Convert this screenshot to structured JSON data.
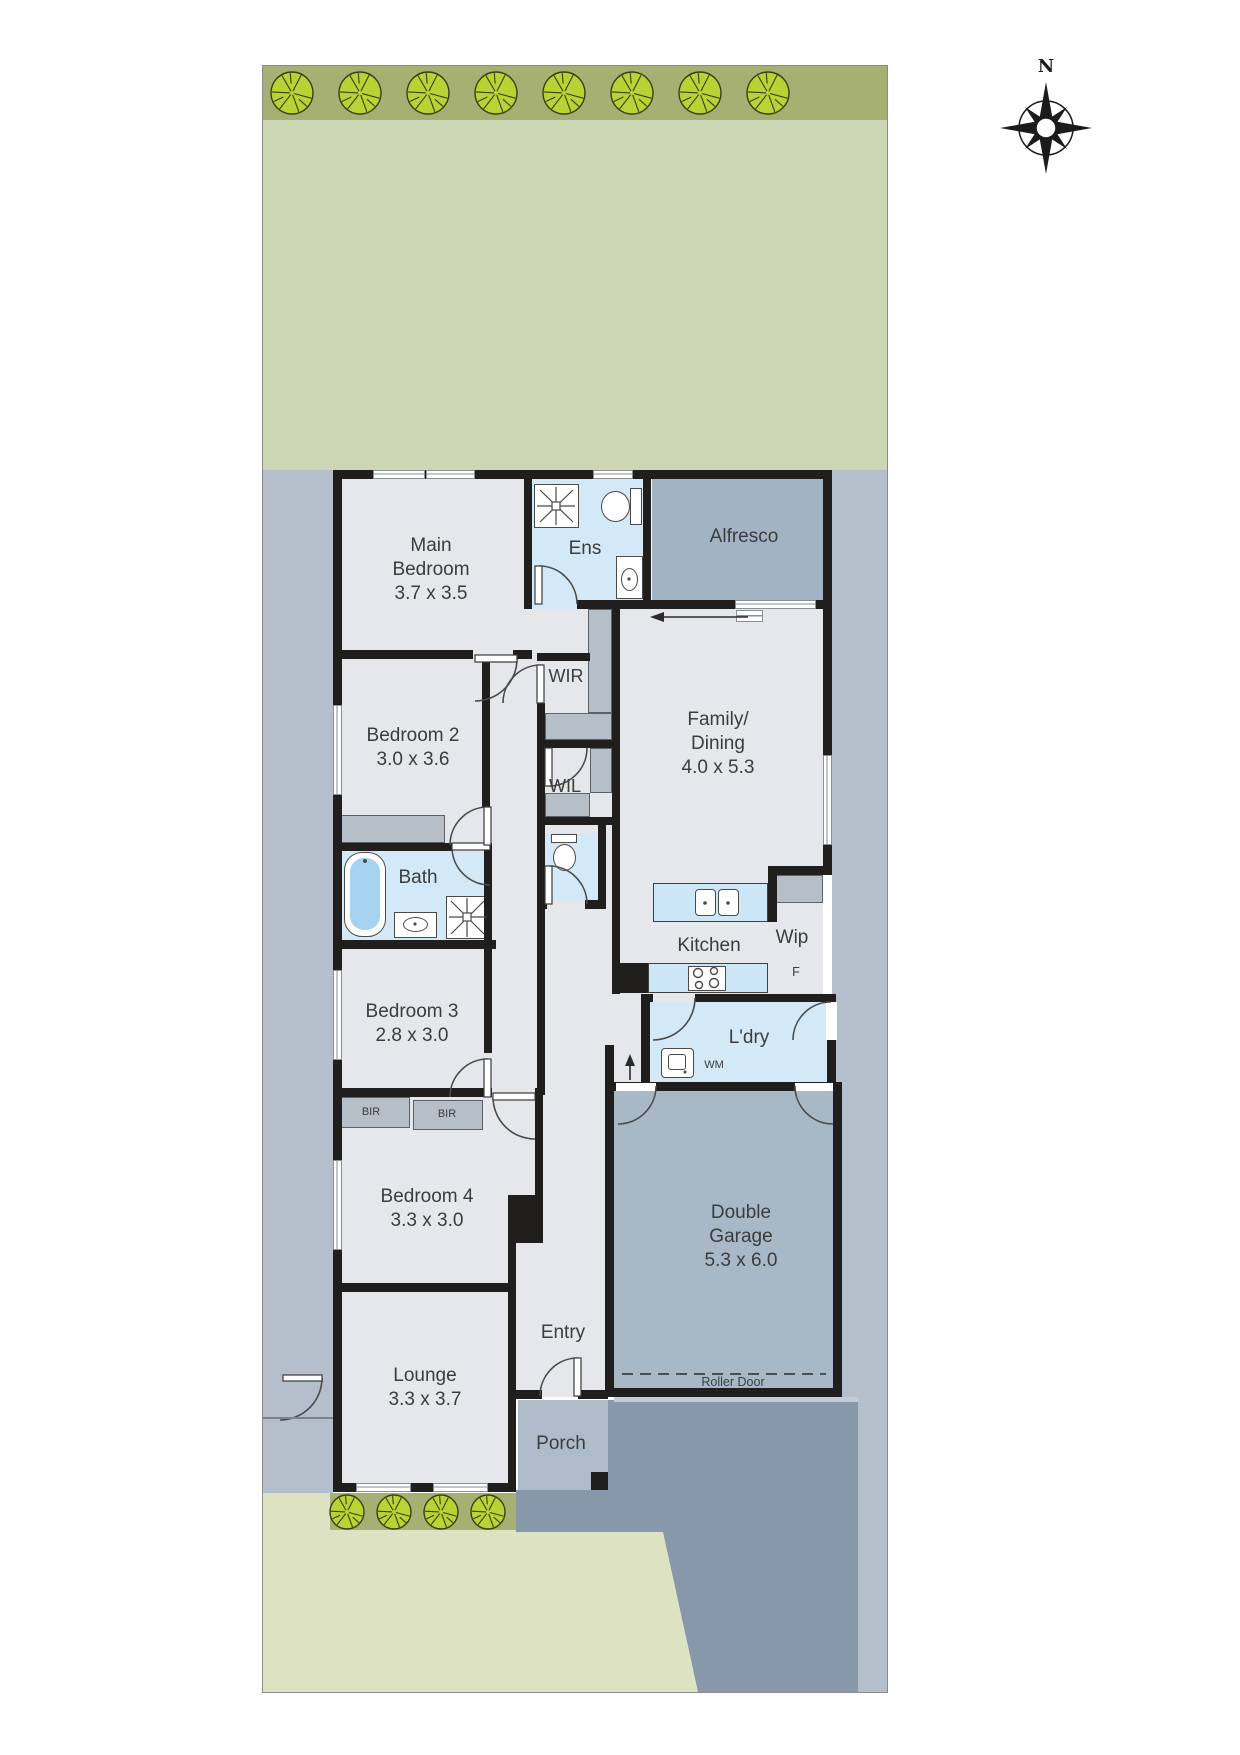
{
  "plan_title": "Residential floor / site plan",
  "compass": {
    "north": "N"
  },
  "rooms": {
    "main_bedroom": {
      "line1": "Main",
      "line2": "Bedroom",
      "dims": "3.7 x 3.5"
    },
    "ens": {
      "label": "Ens"
    },
    "alfresco": {
      "label": "Alfresco"
    },
    "wir": {
      "label": "WIR"
    },
    "wil": {
      "label": "WIL"
    },
    "bedroom2": {
      "line1": "Bedroom 2",
      "dims": "3.0 x 3.6"
    },
    "family": {
      "line1": "Family/",
      "line2": "Dining",
      "dims": "4.0 x 5.3"
    },
    "bath": {
      "label": "Bath"
    },
    "kitchen": {
      "label": "Kitchen"
    },
    "wip": {
      "label": "Wip",
      "fridge": "F"
    },
    "bedroom3": {
      "line1": "Bedroom 3",
      "dims": "2.8 x 3.0"
    },
    "ldry": {
      "label": "L'dry",
      "wm": "WM"
    },
    "bir_left": {
      "label": "BIR"
    },
    "bir_right": {
      "label": "BIR"
    },
    "bedroom4": {
      "line1": "Bedroom 4",
      "dims": "3.3 x 3.0"
    },
    "garage": {
      "line1": "Double",
      "line2": "Garage",
      "dims": "5.3 x 6.0",
      "roller": "Roller Door"
    },
    "entry": {
      "label": "Entry"
    },
    "lounge": {
      "line1": "Lounge",
      "dims": "3.3 x 3.7"
    },
    "porch": {
      "label": "Porch"
    }
  },
  "colors": {
    "wall": "#201f1d",
    "backyard": "#ccd5b4",
    "front_yard": "#dde3c2",
    "tree_band": "#a6b072",
    "tree": "#b9d335",
    "side_yard": "#b5bfcc",
    "driveway": "#8798aa",
    "alfresco": "#a2b4c4",
    "garage": "#a9b8c7",
    "porch": "#aebcca",
    "room": "#e5e7ea",
    "wet_area": "#d3e9f7",
    "robe": "#b6bec8"
  }
}
